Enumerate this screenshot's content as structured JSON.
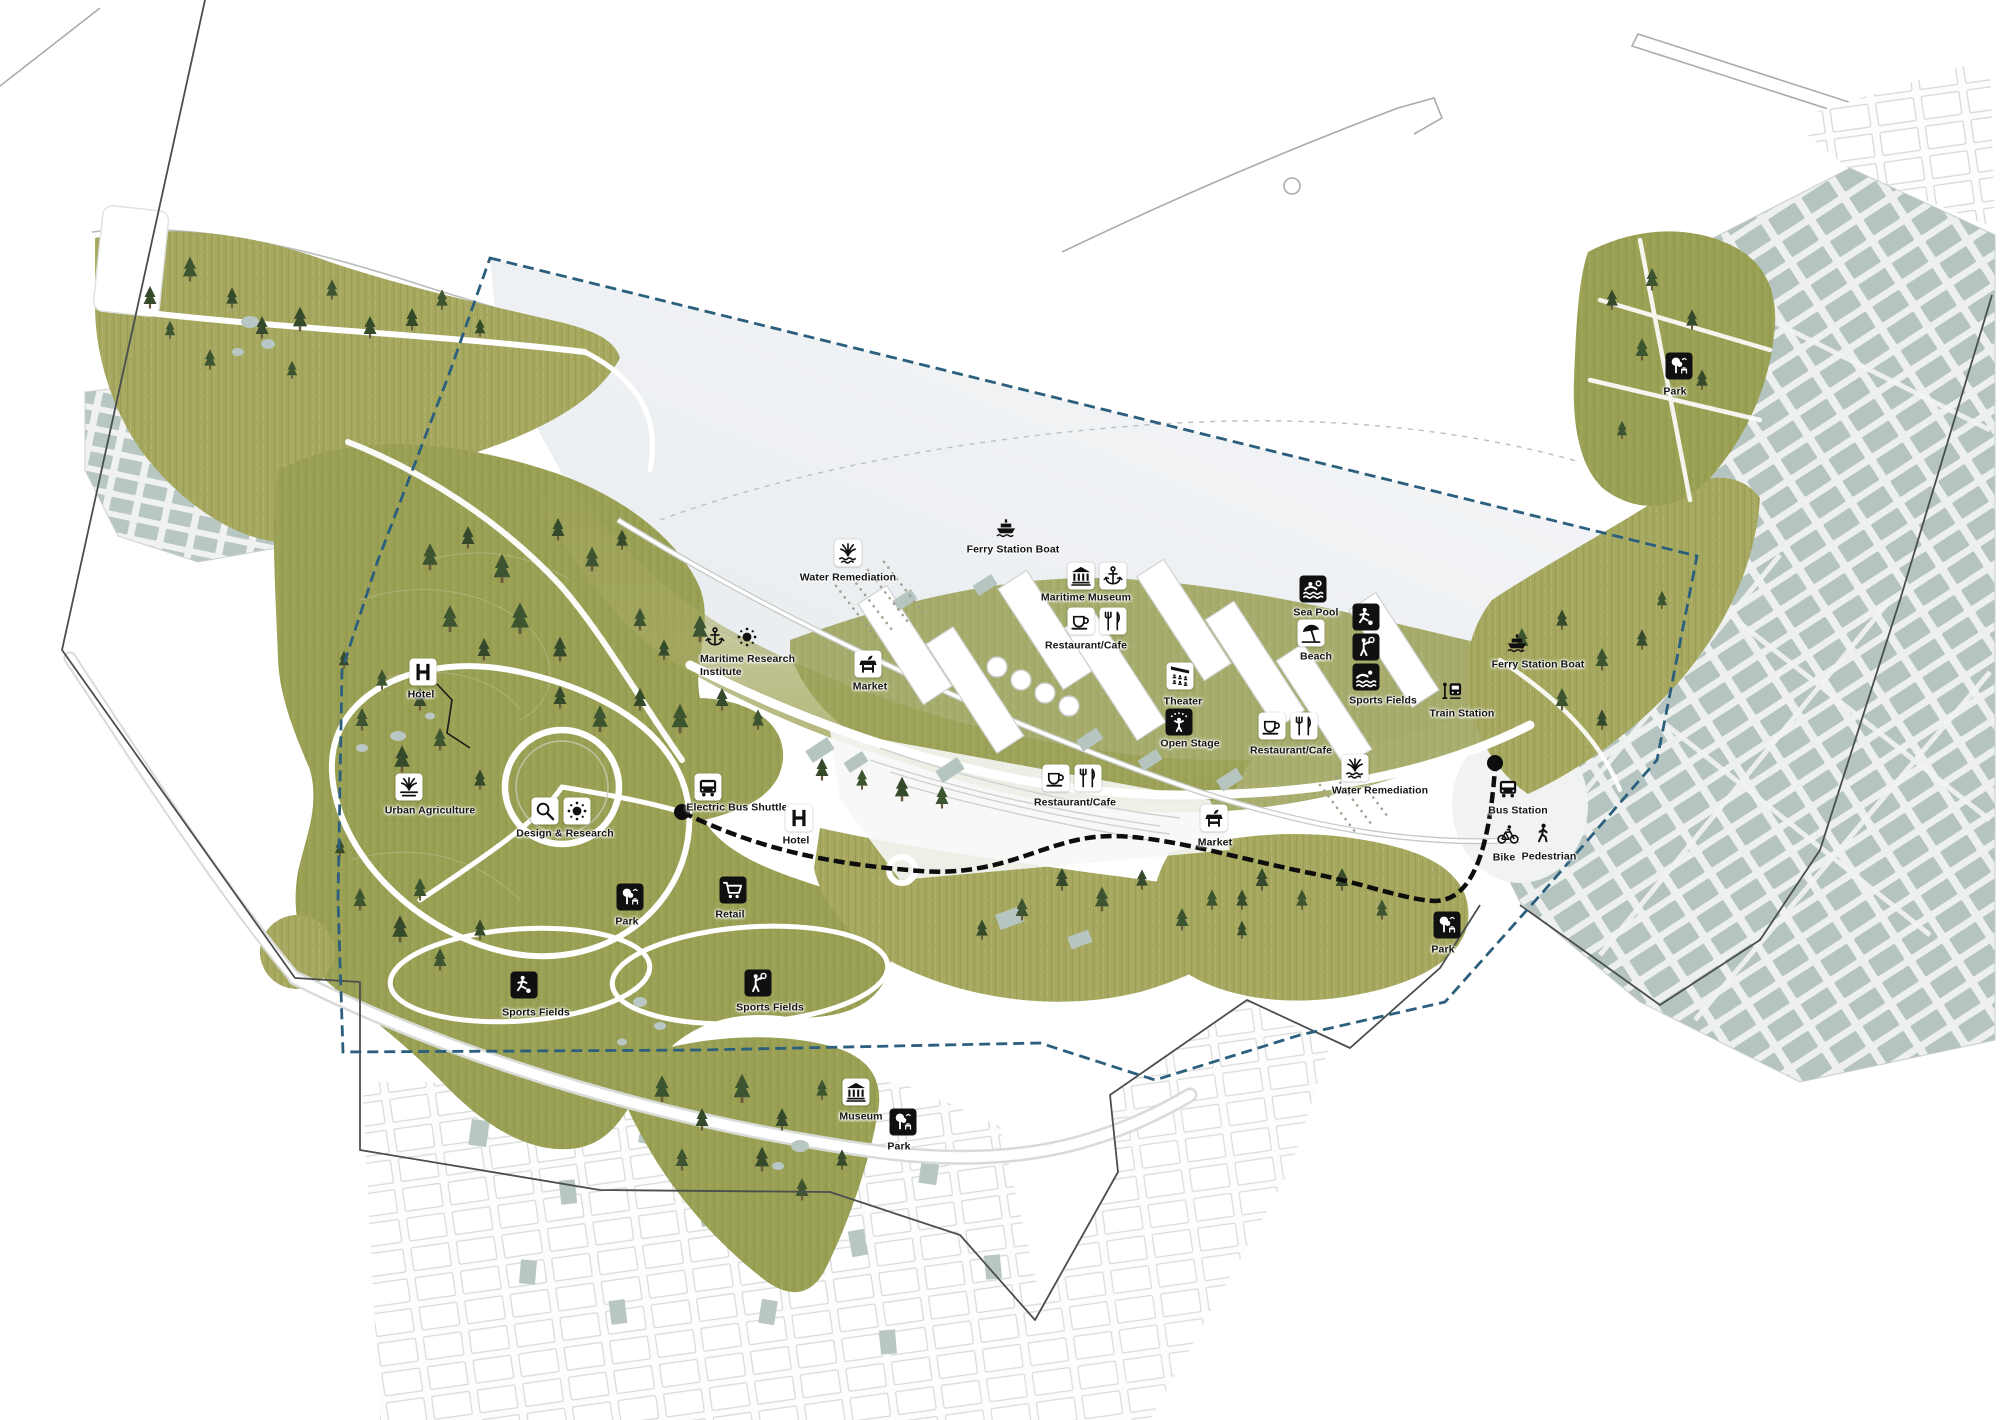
{
  "map": {
    "colors": {
      "park_green": "#a3a65f",
      "park_green_dark": "#9aa054",
      "tree_green": "#35492b",
      "city_block": "#b5c4c0",
      "harbor_water": "#eef1f4",
      "boundary_blue": "#2b5f7d",
      "route_black": "#0d0d0d"
    },
    "pois": [
      {
        "id": "water-remediation-1",
        "label": "Water Remediation",
        "icons": [
          "reeds"
        ],
        "tile": "light",
        "x": 848,
        "y": 553,
        "lx": 848,
        "ly": 578
      },
      {
        "id": "ferry-station-boat-1",
        "label": "Ferry Station Boat",
        "icons": [
          "ferry"
        ],
        "tile": "none",
        "x": 1006,
        "y": 526,
        "lx": 1013,
        "ly": 550
      },
      {
        "id": "maritime-museum",
        "label": "Maritime Museum",
        "icons": [
          "museum",
          "anchor"
        ],
        "tile": "light",
        "x": 1097,
        "y": 576,
        "lx": 1086,
        "ly": 598
      },
      {
        "id": "restaurant-cafe-1",
        "label": "Restaurant/Cafe",
        "icons": [
          "cup",
          "cutlery"
        ],
        "tile": "light",
        "x": 1097,
        "y": 621,
        "lx": 1086,
        "ly": 646
      },
      {
        "id": "sea-pool",
        "label": "Sea Pool",
        "icons": [
          "pool"
        ],
        "tile": "dark",
        "x": 1313,
        "y": 589,
        "lx": 1316,
        "ly": 613
      },
      {
        "id": "beach",
        "label": "Beach",
        "icons": [
          "umbrella"
        ],
        "tile": "light",
        "x": 1311,
        "y": 633,
        "lx": 1316,
        "ly": 657
      },
      {
        "id": "sports-fields-ne",
        "label": "Sports Fields",
        "icons": [
          "soccer",
          "tennis",
          "swim"
        ],
        "tile": "dark",
        "stack": "v",
        "x": 1366,
        "y": 647,
        "lx": 1383,
        "ly": 701
      },
      {
        "id": "theater",
        "label": "Theater",
        "icons": [
          "theaterseats"
        ],
        "tile": "light",
        "x": 1180,
        "y": 676,
        "lx": 1183,
        "ly": 702
      },
      {
        "id": "open-stage",
        "label": "Open Stage",
        "icons": [
          "stage"
        ],
        "tile": "dark",
        "x": 1179,
        "y": 722,
        "lx": 1190,
        "ly": 744
      },
      {
        "id": "restaurant-cafe-2",
        "label": "Restaurant/Cafe",
        "icons": [
          "cup",
          "cutlery"
        ],
        "tile": "light",
        "x": 1288,
        "y": 726,
        "lx": 1291,
        "ly": 751
      },
      {
        "id": "water-remediation-2",
        "label": "Water Remediation",
        "icons": [
          "reeds"
        ],
        "tile": "light",
        "x": 1355,
        "y": 768,
        "lx": 1380,
        "ly": 791
      },
      {
        "id": "market-1",
        "label": "Market",
        "icons": [
          "marketstall"
        ],
        "tile": "light",
        "x": 868,
        "y": 664,
        "lx": 870,
        "ly": 687
      },
      {
        "id": "ferry-station-boat-2",
        "label": "Ferry Station Boat",
        "icons": [
          "ferry"
        ],
        "tile": "none",
        "x": 1517,
        "y": 641,
        "lx": 1538,
        "ly": 665
      },
      {
        "id": "train-station",
        "label": "Train Station",
        "icons": [
          "train"
        ],
        "tile": "none",
        "x": 1452,
        "y": 690,
        "lx": 1462,
        "ly": 714
      },
      {
        "id": "maritime-research-institute",
        "label": "Maritime Research\nInstitute",
        "icons": [
          "anchor",
          "sun"
        ],
        "tile": "none",
        "x": 731,
        "y": 637,
        "lx": 700,
        "ly": 666,
        "anchor": "left"
      },
      {
        "id": "restaurant-cafe-3",
        "label": "Restaurant/Cafe",
        "icons": [
          "cup",
          "cutlery"
        ],
        "tile": "light",
        "x": 1072,
        "y": 778,
        "lx": 1075,
        "ly": 803
      },
      {
        "id": "market-2",
        "label": "Market",
        "icons": [
          "marketstall"
        ],
        "tile": "light",
        "x": 1214,
        "y": 818,
        "lx": 1215,
        "ly": 843
      },
      {
        "id": "bus-station",
        "label": "Bus Station",
        "icons": [
          "bus"
        ],
        "tile": "none",
        "x": 1508,
        "y": 788,
        "lx": 1518,
        "ly": 811
      },
      {
        "id": "bike",
        "label": "Bike",
        "icons": [
          "bike"
        ],
        "tile": "none",
        "x": 1508,
        "y": 835,
        "lx": 1504,
        "ly": 858
      },
      {
        "id": "pedestrian",
        "label": "Pedestrian",
        "icons": [
          "walk"
        ],
        "tile": "none",
        "x": 1543,
        "y": 833,
        "lx": 1549,
        "ly": 857
      },
      {
        "id": "hotel-west",
        "label": "Hotel",
        "icons": [
          "hotelH"
        ],
        "tile": "light",
        "x": 423,
        "y": 672,
        "lx": 421,
        "ly": 695
      },
      {
        "id": "urban-agriculture",
        "label": "Urban Agriculture",
        "icons": [
          "plant"
        ],
        "tile": "light",
        "x": 409,
        "y": 787,
        "lx": 430,
        "ly": 811
      },
      {
        "id": "design-research",
        "label": "Design & Research",
        "icons": [
          "magnifier",
          "sun"
        ],
        "tile": "light",
        "x": 561,
        "y": 811,
        "lx": 565,
        "ly": 834
      },
      {
        "id": "electric-bus-shuttle",
        "label": "Electric Bus Shuttle",
        "icons": [
          "bus"
        ],
        "tile": "light",
        "x": 708,
        "y": 787,
        "lx": 737,
        "ly": 808
      },
      {
        "id": "hotel-central",
        "label": "Hotel",
        "icons": [
          "hotelH"
        ],
        "tile": "light",
        "x": 799,
        "y": 818,
        "lx": 796,
        "ly": 841
      },
      {
        "id": "retail",
        "label": "Retail",
        "icons": [
          "cart"
        ],
        "tile": "dark",
        "x": 733,
        "y": 890,
        "lx": 730,
        "ly": 915
      },
      {
        "id": "park-west",
        "label": "Park",
        "icons": [
          "parktree"
        ],
        "tile": "dark",
        "x": 630,
        "y": 897,
        "lx": 627,
        "ly": 922
      },
      {
        "id": "sports-fields-sw1",
        "label": "Sports Fields",
        "icons": [
          "soccer"
        ],
        "tile": "dark",
        "x": 524,
        "y": 985,
        "lx": 536,
        "ly": 1013
      },
      {
        "id": "sports-fields-sw2",
        "label": "Sports Fields",
        "icons": [
          "tennis"
        ],
        "tile": "dark",
        "x": 758,
        "y": 983,
        "lx": 770,
        "ly": 1008
      },
      {
        "id": "museum-south",
        "label": "Museum",
        "icons": [
          "museum"
        ],
        "tile": "light",
        "x": 856,
        "y": 1092,
        "lx": 861,
        "ly": 1117
      },
      {
        "id": "park-south",
        "label": "Park",
        "icons": [
          "parktree"
        ],
        "tile": "dark",
        "x": 903,
        "y": 1122,
        "lx": 899,
        "ly": 1147
      },
      {
        "id": "park-east",
        "label": "Park",
        "icons": [
          "parktree"
        ],
        "tile": "dark",
        "x": 1447,
        "y": 925,
        "lx": 1443,
        "ly": 950
      },
      {
        "id": "park-ne",
        "label": "Park",
        "icons": [
          "parktree"
        ],
        "tile": "dark",
        "x": 1679,
        "y": 366,
        "lx": 1675,
        "ly": 392
      }
    ]
  }
}
